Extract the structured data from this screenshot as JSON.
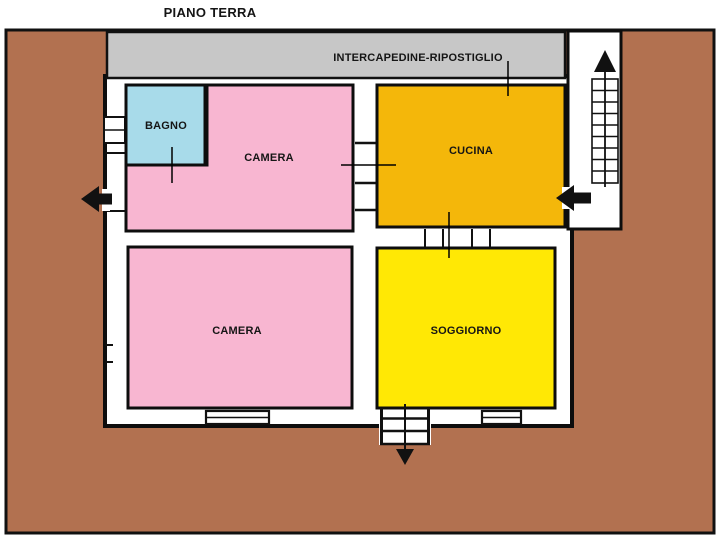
{
  "title": "PIANO TERRA",
  "strip": {
    "label": "INTERCAPEDINE-RIPOSTIGLIO",
    "color": "#c7c7c7"
  },
  "colors": {
    "ground": "#b27150",
    "wall": "#111111",
    "floor_white": "#ffffff",
    "arrow_black": "#111111"
  },
  "rooms": {
    "bagno": {
      "label": "BAGNO",
      "color": "#a8dbea"
    },
    "camera_top": {
      "label": "CAMERA",
      "color": "#f8b6d1"
    },
    "cucina": {
      "label": "CUCINA",
      "color": "#f4b70a"
    },
    "camera_bottom": {
      "label": "CAMERA",
      "color": "#f8b6d1"
    },
    "soggiorno": {
      "label": "SOGGIORNO",
      "color": "#ffe805"
    }
  },
  "icons": {
    "stairs_up_arrow": "up-arrow",
    "left_exit_arrow": "left-arrow",
    "right_entry_arrow": "left-arrow",
    "entrance_down_arrow": "down-arrow"
  }
}
